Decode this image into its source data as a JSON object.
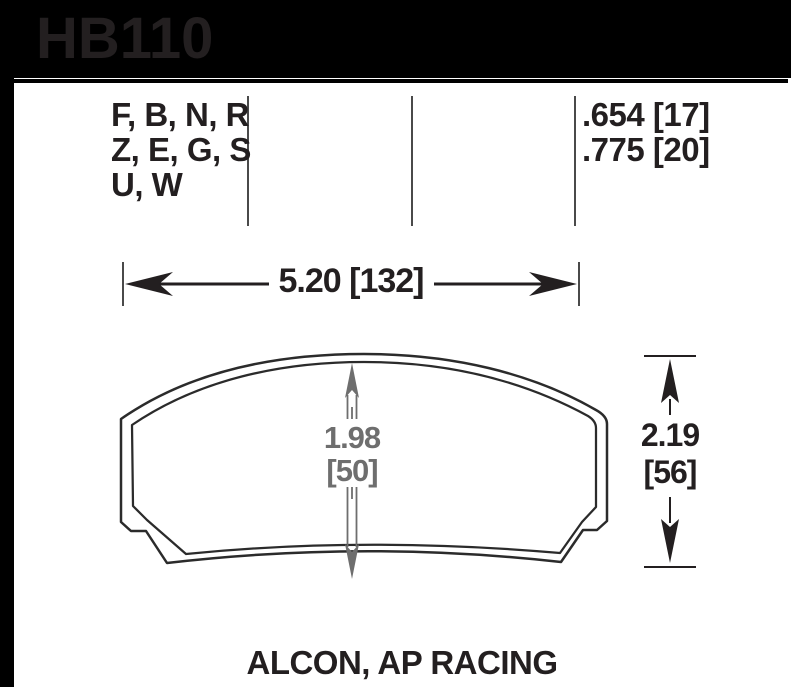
{
  "header": {
    "part_number": "HB110"
  },
  "spec_table": {
    "compound_lines": [
      "F, B, N, R",
      "Z, E, G, S",
      "U, W"
    ],
    "thickness_lines": [
      ".654 [17]",
      ".775 [20]"
    ]
  },
  "dimensions": {
    "overall_width": "5.20 [132]",
    "center_height_in": "1.98",
    "center_height_mm": "[50]",
    "overall_height_in": "2.19",
    "overall_height_mm": "[56]"
  },
  "caption": {
    "applications": "ALCON, AP RACING"
  },
  "colors": {
    "header_bg": "#000000",
    "drawing_line": "#2b2b2b",
    "dim_gray": "#6e6e6e",
    "text_color": "#231f20"
  }
}
